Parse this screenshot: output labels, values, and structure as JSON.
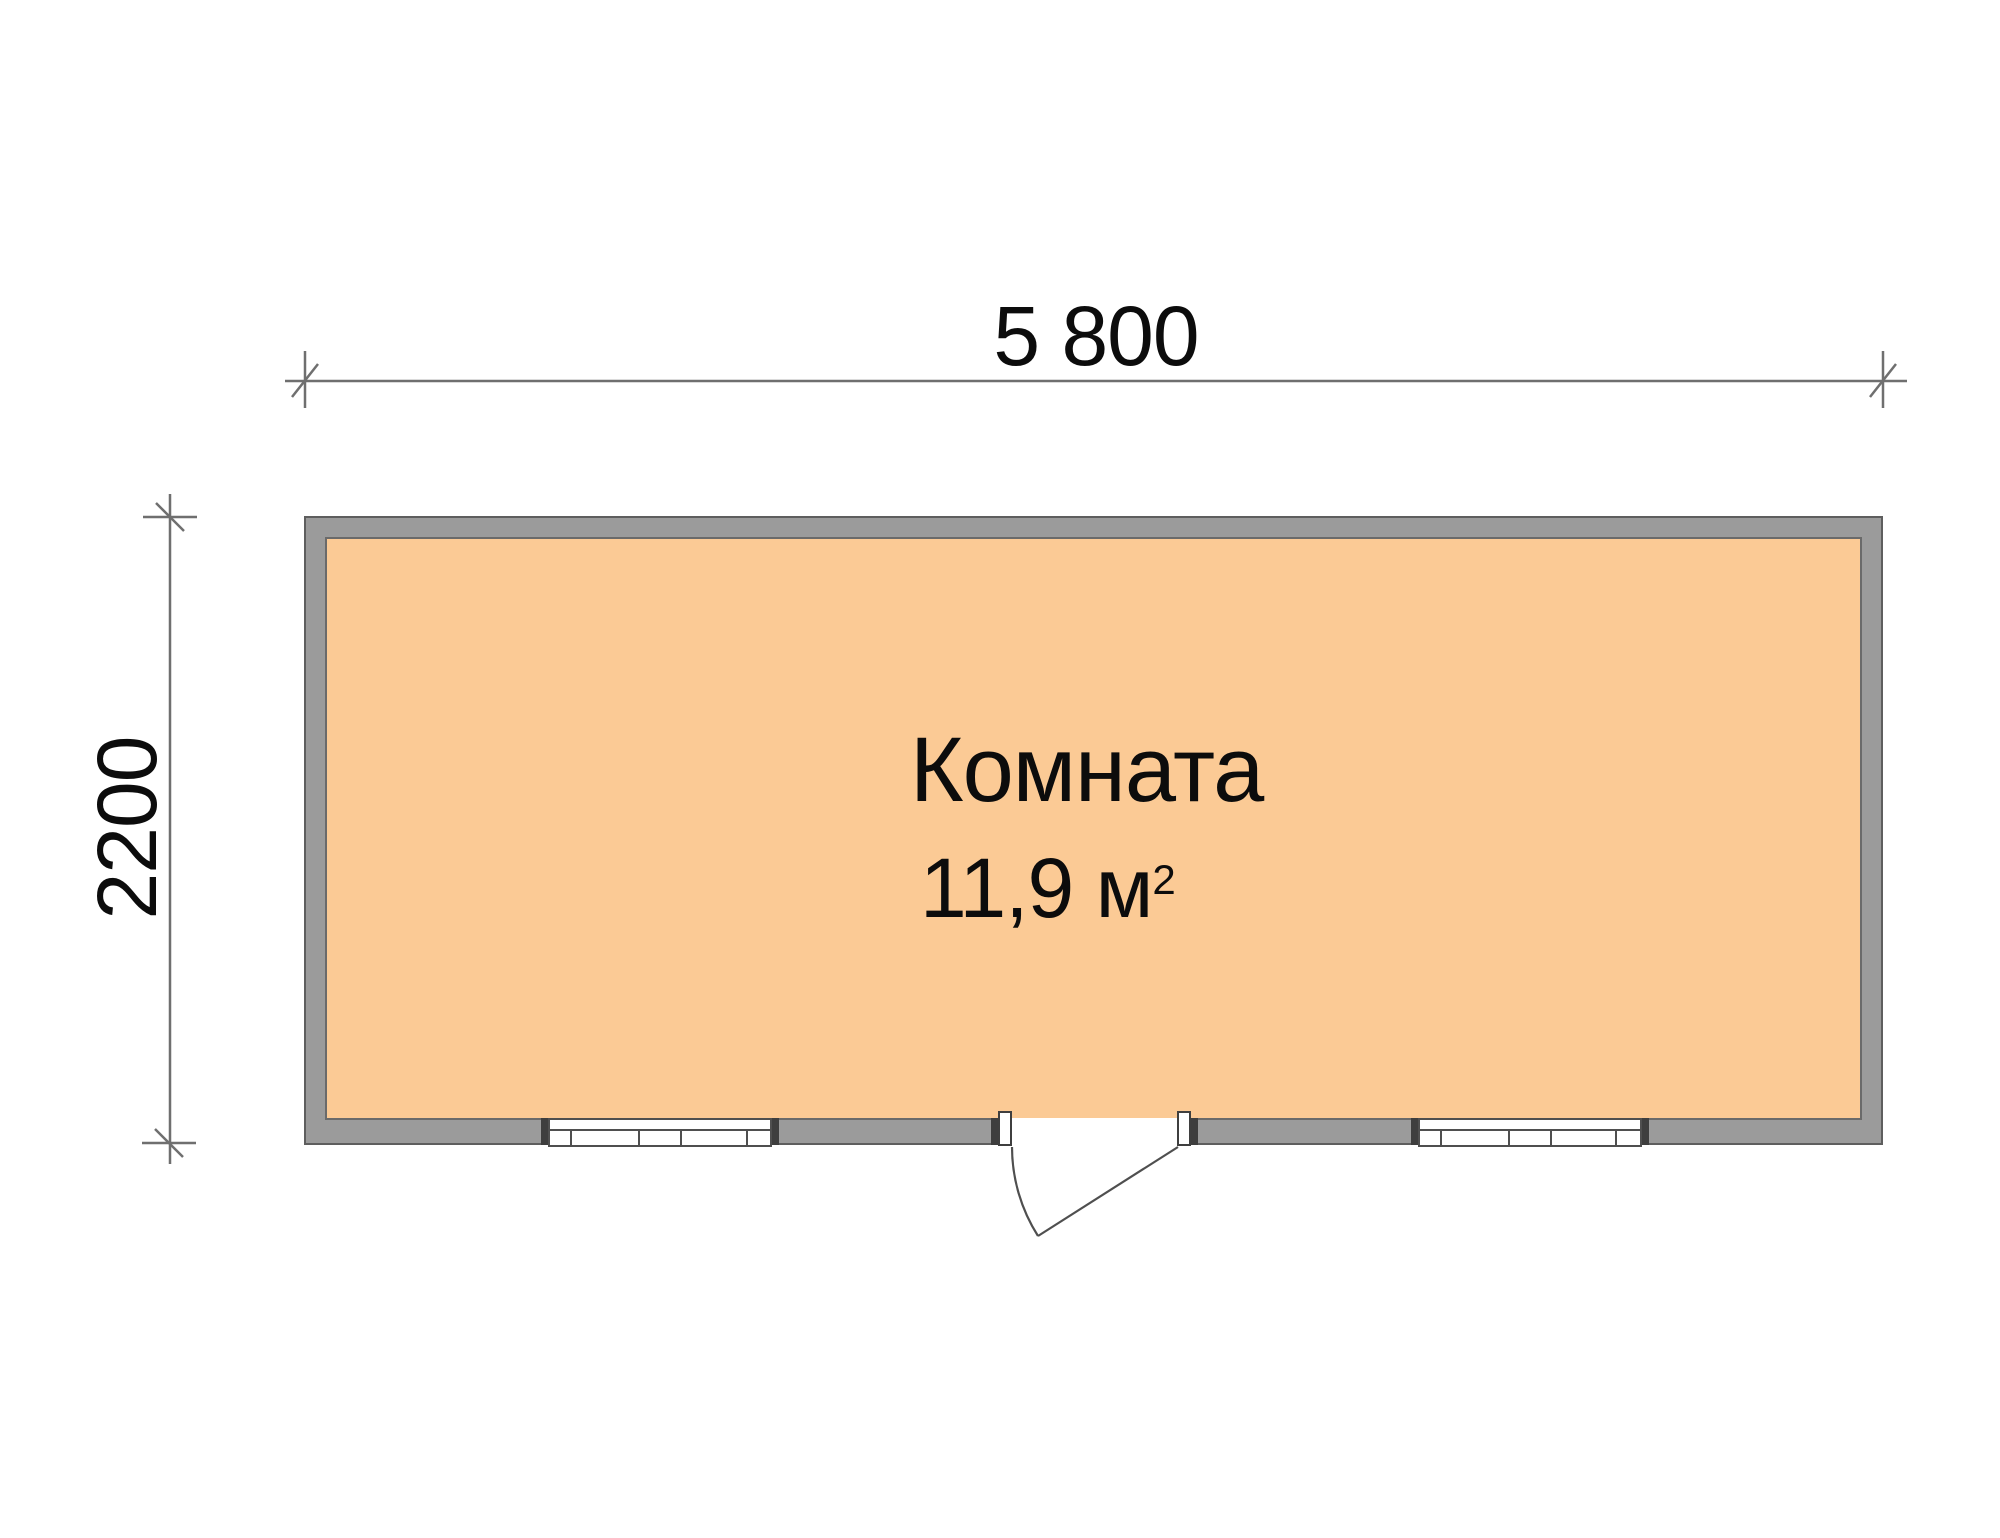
{
  "dimensions": {
    "width_label": "5 800",
    "height_label": "2200"
  },
  "room": {
    "name": "Комната",
    "area_text": "11,9 м",
    "area_superscript": "2"
  },
  "colors": {
    "wall": "#9b9b9b",
    "wall_outline": "#5e5e5e",
    "floor": "#fbca95",
    "line": "#4f4f4f",
    "dim": "#6f6f6f",
    "text": "#0c0c0c"
  }
}
